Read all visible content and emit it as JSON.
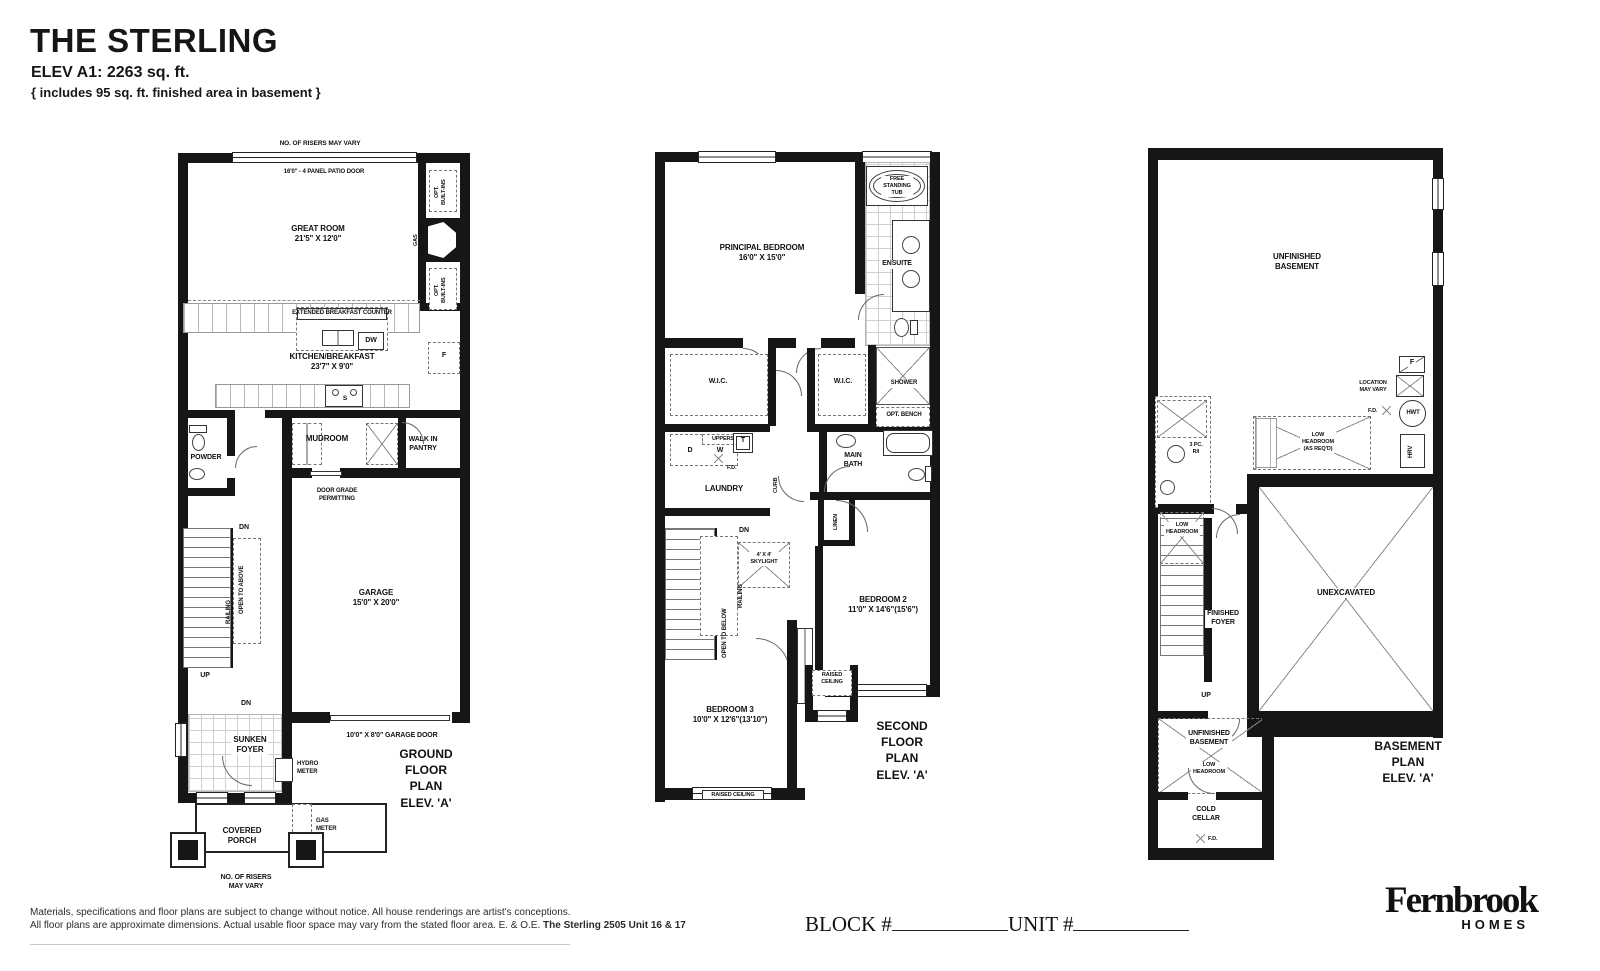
{
  "header": {
    "title": "THE STERLING",
    "elevation": "ELEV A1: 2263 sq. ft.",
    "note": "{ includes 95 sq. ft. finished area in basement }"
  },
  "ground": {
    "plan_name": "GROUND FLOOR PLAN\nELEV. 'A'",
    "risers_top": "NO. OF RISERS MAY VARY",
    "patio_door": "16'0\" - 4 PANEL PATIO DOOR",
    "great_room": "GREAT ROOM\n21'5\" X 12'0\"",
    "opt_builtins_a": "OPT.\nBUILT-INS",
    "gas_fireplace": "GAS FIREPLACE",
    "opt_builtins_b": "OPT.\nBUILT-INS",
    "ext_counter": "EXTENDED BREAKFAST COUNTER",
    "dw": "DW",
    "kitchen": "KITCHEN/BREAKFAST\n23'7\" X 9'0\"",
    "fridge": "F",
    "sink": "S",
    "powder": "POWDER",
    "mudroom": "MUDROOM",
    "pantry": "WALK IN\nPANTRY",
    "door_grade": "DOOR GRADE\nPERMITTING",
    "dn_stairs": "DN",
    "open_above": "OPEN TO ABOVE",
    "railing": "RAILING",
    "up": "UP",
    "garage": "GARAGE\n15'0\" X 20'0\"",
    "dn_foyer": "DN",
    "foyer": "SUNKEN\nFOYER",
    "hydro": "HYDRO\nMETER",
    "garage_door": "10'0\" X 8'0\" GARAGE DOOR",
    "porch": "COVERED\nPORCH",
    "gas_meter": "GAS\nMETER",
    "risers_bottom": "NO. OF RISERS\nMAY VARY"
  },
  "second": {
    "plan_name": "SECOND FLOOR PLAN\nELEV. 'A'",
    "principal": "PRINCIPAL BEDROOM\n16'0\" X 15'0\"",
    "tub": "FREE\nSTANDING\nTUB",
    "ensuite": "ENSUITE",
    "wic_l": "W.I.C.",
    "wic_r": "W.I.C.",
    "shower": "SHOWER",
    "bench": "OPT. BENCH",
    "uppers": "UPPERS",
    "d": "D",
    "w": "W",
    "t": "T",
    "fd": "F.D.",
    "laundry": "LAUNDRY",
    "curb": "CURB",
    "bath": "MAIN\nBATH",
    "linen": "LINEN",
    "dn": "DN",
    "skylight": "4' X 4'\nSKYLIGHT",
    "railing": "RAILING",
    "open_below": "OPEN TO BELOW",
    "bed2": "BEDROOM 2\n11'0\" X 14'6\"(15'6\")",
    "raised_a": "RAISED\nCEILING",
    "bed3": "BEDROOM 3\n10'0\" X 12'6\"(13'10\")",
    "raised_b": "RAISED CEILING"
  },
  "basement": {
    "plan_name": "BASEMENT PLAN\nELEV. 'A'",
    "unfinished": "UNFINISHED\nBASEMENT",
    "location": "LOCATION\nMAY VARY",
    "furnace": "F",
    "fd_a": "F.D.",
    "hwt": "HWT",
    "hrv": "HRV",
    "pc3": "3 PC.\nR/I",
    "low_req": "LOW\nHEADROOM\n(AS REQ'D)",
    "low_a": "LOW\nHEADROOM",
    "foyer": "FINISHED\nFOYER",
    "unexcavated": "UNEXCAVATED",
    "up": "UP",
    "unfinished_b": "UNFINISHED\nBASEMENT",
    "low_b": "LOW\nHEADROOM",
    "cold": "COLD\nCELLAR",
    "fd_b": "F.D."
  },
  "footer": {
    "line1": "Materials, specifications and floor plans are subject to change without notice. All house renderings are artist's conceptions.",
    "line2": "All floor plans are approximate dimensions. Actual usable floor space may vary from the stated floor area. E. & O.E. ",
    "line2b": "The Sterling 2505 Unit 16 & 17",
    "block": "BLOCK #",
    "unit": "UNIT #",
    "logo_name": "Fernbrook",
    "logo_sub": "HOMES"
  }
}
